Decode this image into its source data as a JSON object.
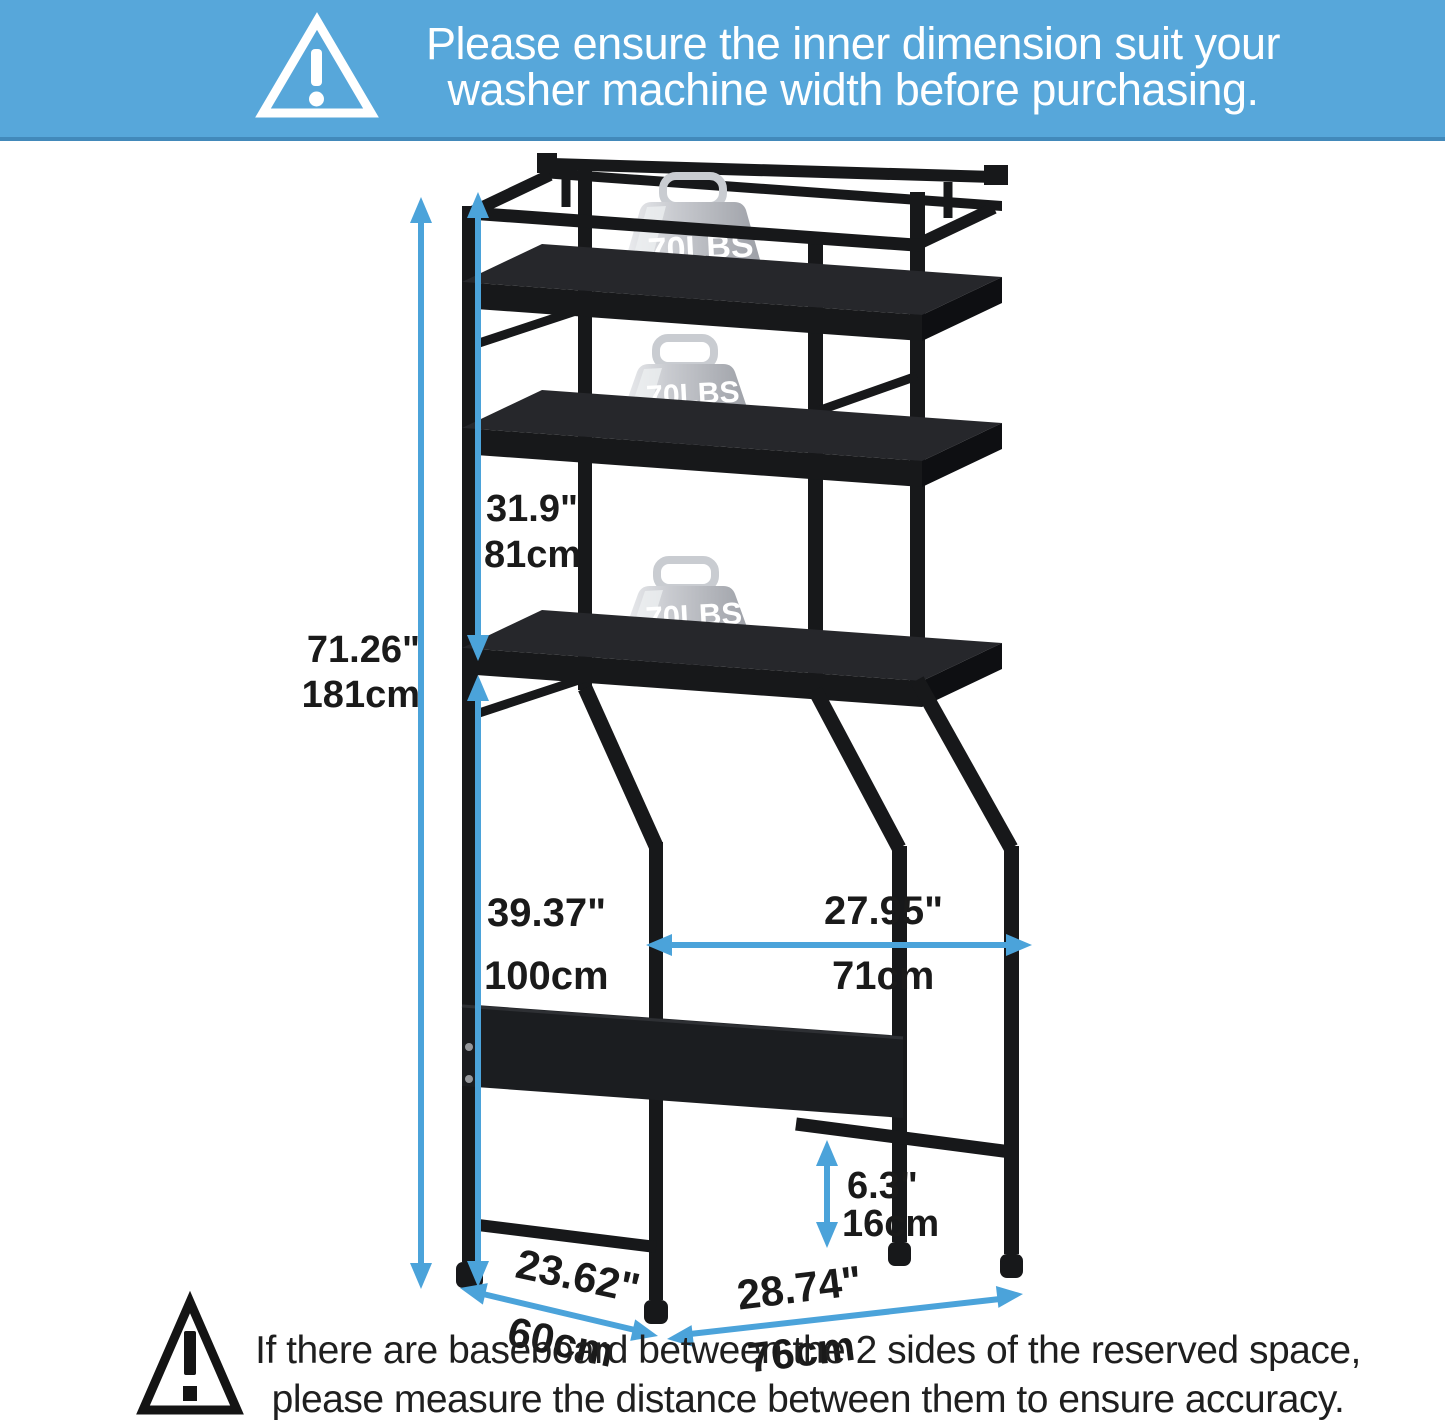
{
  "colors": {
    "banner_bg": "#57a7da",
    "banner_edge": "#4289ba",
    "accent": "#4ba3da",
    "frame": "#17181a",
    "panel": "#1b1d20",
    "label": "#1a1a1a",
    "white": "#ffffff"
  },
  "banner": {
    "icon": "warning-triangle-icon",
    "line1": "Please ensure the inner dimension suit your",
    "line2": "washer machine width before purchasing."
  },
  "weights": [
    {
      "weight_lbs": "70LBS",
      "weight_kg": "31.7KG"
    },
    {
      "weight_lbs": "70LBS",
      "weight_kg": "31.7KG"
    },
    {
      "weight_lbs": "70LBS",
      "weight_kg": "31.7KG"
    }
  ],
  "dimensions": {
    "total_height": {
      "in": "71.26\"",
      "cm": "181cm"
    },
    "shelf_section_height": {
      "in": "31.9\"",
      "cm": "81cm"
    },
    "clearance_height": {
      "in": "39.37\"",
      "cm": "100cm"
    },
    "inner_width": {
      "in": "27.95\"",
      "cm": "71cm"
    },
    "bottom_bar_height": {
      "in": "6.3\"",
      "cm": "16cm"
    },
    "depth": {
      "in": "23.62\"",
      "cm": "60cm"
    },
    "outer_width": {
      "in": "28.74\"",
      "cm": "76cm"
    }
  },
  "footer": {
    "icon": "warning-triangle-icon",
    "line1": "If there are baseboard between the 2 sides of the reserved space,",
    "line2": "please measure the distance between them to ensure accuracy."
  }
}
